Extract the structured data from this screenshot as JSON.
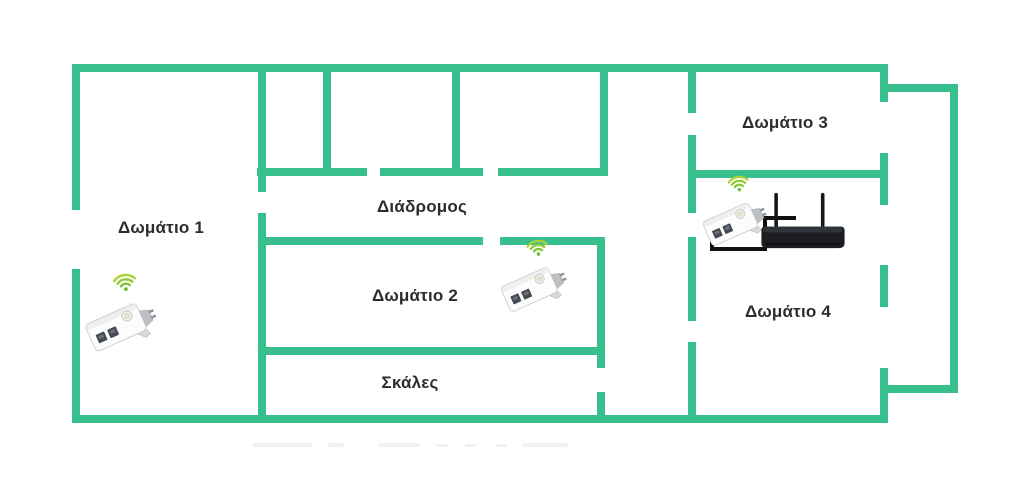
{
  "diagram": {
    "type": "floor-plan",
    "rooms": [
      {
        "id": "room-1",
        "label": "Δωμάτιο 1"
      },
      {
        "id": "corridor",
        "label": "Διάδρομος"
      },
      {
        "id": "room-2",
        "label": "Δωμάτιο 2"
      },
      {
        "id": "stairs",
        "label": "Σκάλες"
      },
      {
        "id": "room-3",
        "label": "Δωμάτιο 3"
      },
      {
        "id": "room-4",
        "label": "Δωμάτιο 4"
      }
    ],
    "devices": [
      {
        "icon": "wifi-adapter-icon",
        "type": "powerline-wifi-adapter",
        "location": "Δωμάτιο 1"
      },
      {
        "icon": "wifi-adapter-icon",
        "type": "powerline-wifi-adapter",
        "location": "Δωμάτιο 2"
      },
      {
        "icon": "wifi-adapter-icon",
        "type": "powerline-wifi-adapter",
        "location": "Δωμάτιο 4"
      },
      {
        "icon": "router-icon",
        "type": "wifi-router",
        "location": "Δωμάτιο 4"
      },
      {
        "icon": "ethernet-cable-icon",
        "type": "cable",
        "location": "Δωμάτιο 4"
      }
    ],
    "colors": {
      "wall": "#37bf8e",
      "wifi_signal": "#95c93c",
      "router_body": "#1b1d22",
      "label_text": "#2d2d2d",
      "background": "#ffffff"
    }
  }
}
